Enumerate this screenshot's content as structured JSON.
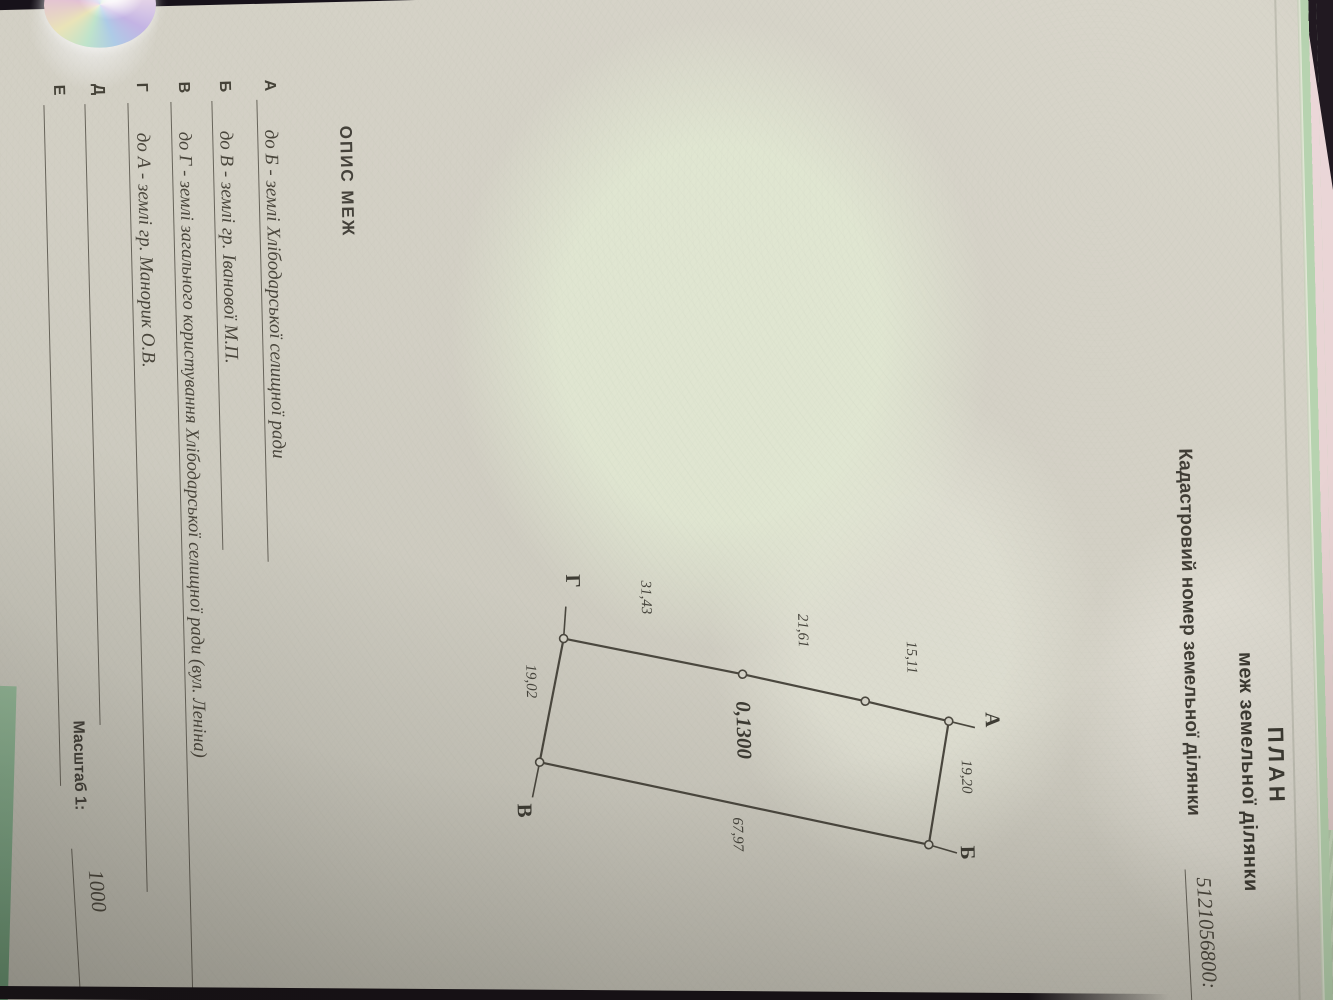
{
  "title_block": {
    "title": "ПЛАН",
    "subtitle": "меж земельної ділянки",
    "cadastral_label": "Кадастровий номер земельної ділянки",
    "cadastral_number": "5121056800:"
  },
  "plan": {
    "area_value": "0,1300",
    "vertex_labels": {
      "a": "А",
      "b": "Б",
      "v": "В",
      "g": "Г"
    },
    "dims": {
      "ab": "19,20",
      "bv": "67,97",
      "gv": "19,02",
      "a_seg": "15,11",
      "mid_seg": "21,61",
      "g_seg": "31,43"
    }
  },
  "boundaries": {
    "heading": "ОПИС МЕЖ",
    "rows": [
      {
        "letter": "А",
        "text": "до Б - землі Хлібодарської селищної ради"
      },
      {
        "letter": "Б",
        "text": "до В - землі гр. Іванової М.П."
      },
      {
        "letter": "В",
        "text": "до Г - землі загального користування Хлібодарської селищної ради (вул. Леніна)"
      },
      {
        "letter": "Г",
        "text": "до А - землі гр. Манорик О.В."
      },
      {
        "letter": "Д",
        "text": ""
      },
      {
        "letter": "Е",
        "text": ""
      }
    ]
  },
  "scale_block": {
    "label": "Масштаб 1:",
    "value": "1000"
  },
  "colors": {
    "paper": "#d2cfc4",
    "form_edge_green": "#b7d3b0",
    "backdrop_pink": "#ecd8da",
    "background_dark": "#17121a",
    "ink": "#454238"
  }
}
